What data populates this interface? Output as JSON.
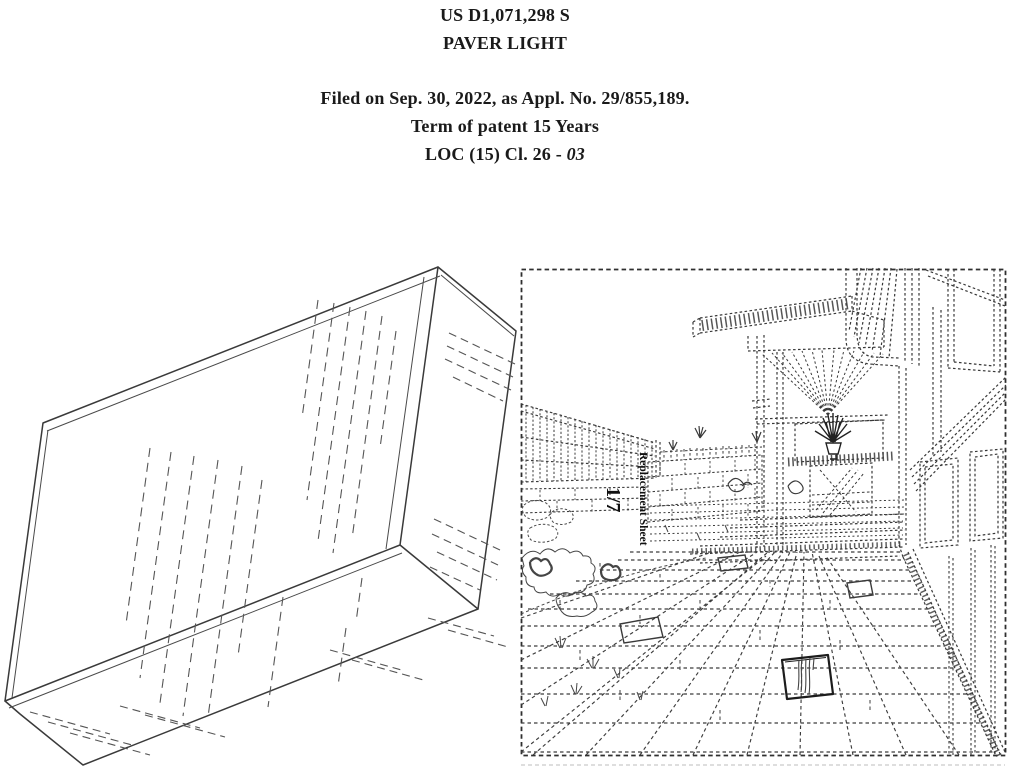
{
  "header": {
    "patent_number": "US D1,071,298 S",
    "title": "PAVER LIGHT",
    "filed": "Filed on Sep. 30, 2022, as Appl. No. 29/855,189.",
    "term": "Term of patent 15 Years",
    "loc_prefix": "LOC (15) Cl. 26 - ",
    "loc_class": "03"
  },
  "figures": {
    "environment": {
      "sheet_label": "Replacement Sheet",
      "sheet_number": "1/7"
    }
  },
  "colors": {
    "background": "#ffffff",
    "ink": "#2f2f2f",
    "dashed_ink": "#333333"
  }
}
